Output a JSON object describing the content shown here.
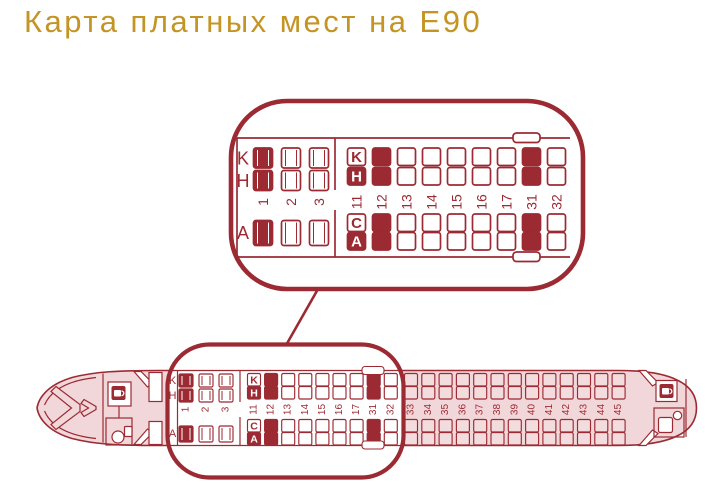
{
  "title": "Карта платных мест на Е90",
  "colors": {
    "accent": "#9B2A33",
    "seat_paid_fill": "#9B2A33",
    "fuselage_fill": "#F1D7D9",
    "rear_seat_fill": "#F3DCDE",
    "title_color": "#C49425",
    "background": "#FFFFFF"
  },
  "seat_letters": {
    "top_window": "K",
    "top_aisle": "H",
    "bottom_aisle": "C",
    "bottom_window": "A"
  },
  "cabin": {
    "business_rows": [
      {
        "number": "1",
        "seats": {
          "K": true,
          "H": true,
          "A": true
        }
      },
      {
        "number": "2",
        "seats": {
          "K": false,
          "H": false,
          "A": false
        }
      },
      {
        "number": "3",
        "seats": {
          "K": false,
          "H": false,
          "A": false
        }
      }
    ],
    "economy_front_rows": [
      {
        "number": "11",
        "lettered": true,
        "seats": {
          "K": false,
          "H": true,
          "C": false,
          "A": true
        }
      },
      {
        "number": "12",
        "seats": {
          "K": true,
          "H": true,
          "C": true,
          "A": true
        }
      },
      {
        "number": "13",
        "seats": {
          "K": false,
          "H": false,
          "C": false,
          "A": false
        }
      },
      {
        "number": "14",
        "seats": {
          "K": false,
          "H": false,
          "C": false,
          "A": false
        }
      },
      {
        "number": "15",
        "seats": {
          "K": false,
          "H": false,
          "C": false,
          "A": false
        }
      },
      {
        "number": "16",
        "seats": {
          "K": false,
          "H": false,
          "C": false,
          "A": false
        }
      },
      {
        "number": "17",
        "seats": {
          "K": false,
          "H": false,
          "C": false,
          "A": false
        }
      },
      {
        "number": "31",
        "seats": {
          "K": true,
          "H": true,
          "C": true,
          "A": true
        }
      },
      {
        "number": "32",
        "seats": {
          "K": false,
          "H": false,
          "C": false,
          "A": false
        }
      }
    ],
    "economy_rear_rows": [
      "33",
      "34",
      "35",
      "36",
      "37",
      "38",
      "39",
      "40",
      "41",
      "42",
      "43",
      "44",
      "45"
    ]
  },
  "icons": {
    "front_galley": "coffee-cup-icon",
    "front_lavatory": "toilet-icon",
    "rear_galley": "coffee-cup-icon",
    "rear_lavatory": "toilet-icon",
    "exits": "emergency-exit-marker"
  }
}
